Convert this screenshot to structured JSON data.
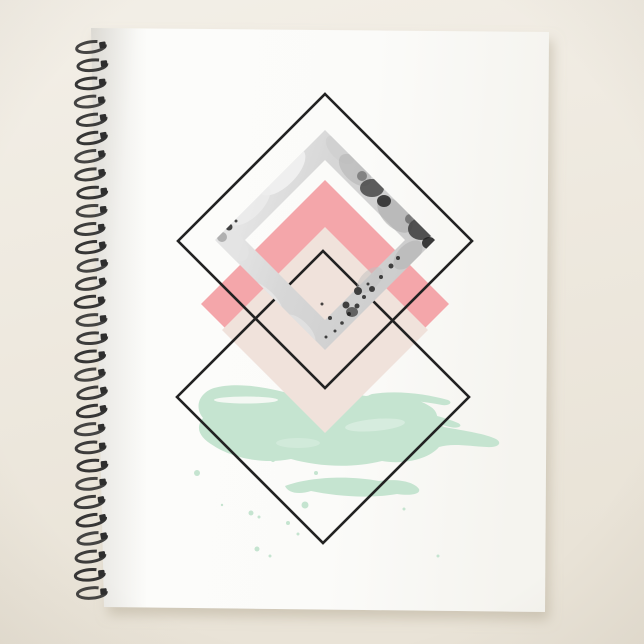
{
  "meta": {
    "alt": "Spiral-bound planner notebook with white cover showing a geometric artwork of overlapping diamonds in black outline, marble gray, coral pink, blush, and a mint green watercolor brushstroke",
    "product_type": "spiral planner"
  },
  "colors": {
    "background_top": "#f3efe7",
    "background_bottom": "#e9e3d7",
    "drop_shadow": "#b3a994",
    "cover_white": "#fcfcfa",
    "cover_spine_shade": "#efeeea",
    "cover_edge_shade": "#f5f4ef",
    "diamond_outline": "#222222",
    "coral_pink": "#f4a6aa",
    "blush": "#f0e2db",
    "mint_green": "#c5e4d0",
    "marble_light": "#f0f0f0",
    "marble_mid": "#cccccc",
    "marble_base": "#d7d7d7",
    "marble_dark": "#1a1a1a",
    "wire": "#2e2e2e"
  },
  "spiral": {
    "coil_count": 31,
    "start_y": 47,
    "spacing": 18.2,
    "cx": 91,
    "rx": 14.5,
    "ry": 5.2,
    "stroke_width": 3
  },
  "artwork": {
    "style": "geometric watercolor",
    "elements": [
      "upper-black-diamond-outline",
      "lower-black-diamond-outline",
      "marble-diamond-frame",
      "coral-pink-diamond",
      "blush-diamond",
      "mint-brushstroke",
      "paint-splatter-dots"
    ],
    "marble_speckles": [
      [
        391,
        266,
        2.5
      ],
      [
        381,
        277,
        2
      ],
      [
        372,
        289,
        3
      ],
      [
        364,
        297,
        2
      ],
      [
        357,
        306,
        2.5
      ],
      [
        349,
        314,
        2
      ],
      [
        342,
        323,
        1.8
      ],
      [
        335,
        331,
        1.5
      ],
      [
        368,
        284,
        1.5
      ],
      [
        346,
        305,
        3.5
      ],
      [
        330,
        318,
        2
      ],
      [
        326,
        337,
        1.5
      ],
      [
        398,
        258,
        2
      ],
      [
        358,
        291,
        4
      ],
      [
        305,
        143,
        1.5
      ],
      [
        315,
        136,
        1.2
      ],
      [
        229,
        227,
        3.5
      ],
      [
        213,
        243,
        2
      ],
      [
        236,
        221,
        1.5
      ],
      [
        322,
        304,
        1.5
      ]
    ],
    "splatter_dots": [
      [
        197,
        473,
        3
      ],
      [
        273,
        460,
        2
      ],
      [
        305,
        505,
        3.5
      ],
      [
        316,
        473,
        2
      ],
      [
        251,
        513,
        2.5
      ],
      [
        259,
        517,
        1.5
      ],
      [
        288,
        523,
        2
      ],
      [
        257,
        549,
        2.5
      ],
      [
        270,
        556,
        1.5
      ],
      [
        438,
        556,
        1.5
      ],
      [
        222,
        505,
        1.2
      ],
      [
        298,
        534,
        1.5
      ],
      [
        404,
        509,
        1.5
      ]
    ]
  }
}
